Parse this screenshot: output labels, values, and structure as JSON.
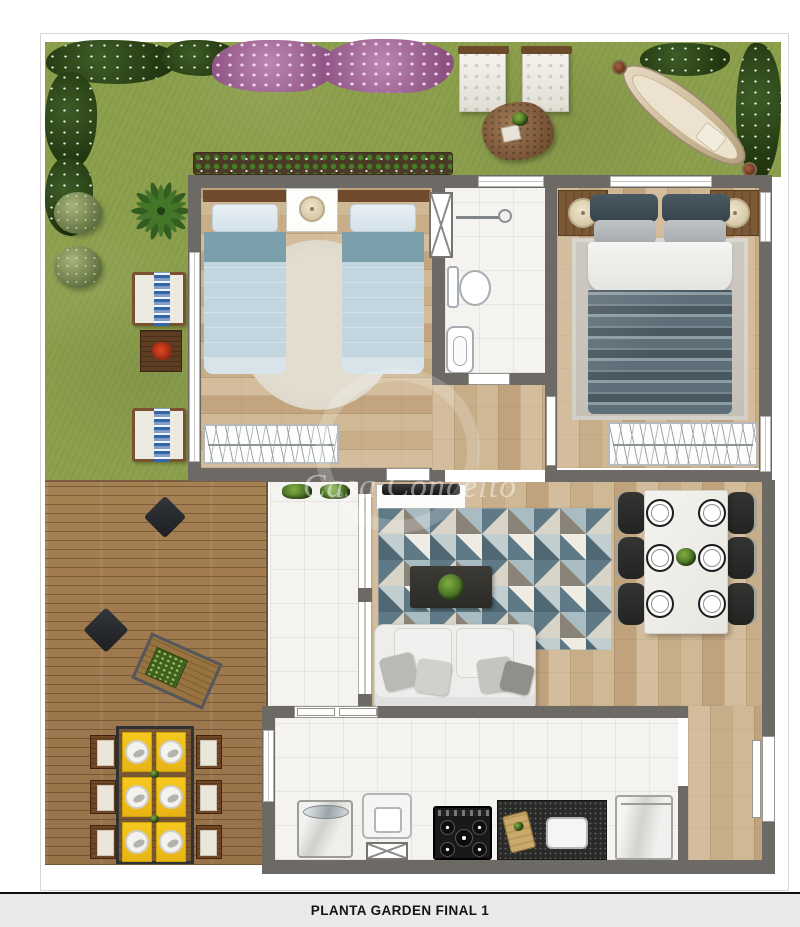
{
  "page": {
    "title": "PLANTA GARDEN FINAL 1",
    "watermark": "Casa Conceito"
  },
  "plan": {
    "type": "residential-floor-plan-top-view",
    "rooms": [
      "garden",
      "wood-deck",
      "patio",
      "twin-bedroom",
      "bathroom",
      "master-bedroom",
      "hall",
      "living-room",
      "dining-room",
      "kitchen",
      "entry"
    ],
    "garden_features": [
      "white-flower-hedge",
      "purple-flower-bed",
      "round-bushes",
      "palm-plant",
      "two-lounge-armchairs",
      "side-table-with-red-flowers",
      "two-white-poufs",
      "rock-planting-mound",
      "hammock",
      "planter-strip"
    ],
    "deck_features": [
      "two-floor-cushions",
      "wood-lounger-with-tray",
      "outdoor-table-for-six",
      "yellow-placemats",
      "six-wood-chairs"
    ],
    "furniture": {
      "twin_bedroom": [
        "twin-bed-left",
        "twin-bed-right",
        "shared-nightstand-with-lamp",
        "round-rug",
        "wardrobe"
      ],
      "bathroom": [
        "shower-with-grab-bar",
        "toilet",
        "sink"
      ],
      "master_bedroom": [
        "double-bed",
        "nightstand-lamp-left",
        "nightstand-lamp-right",
        "area-rug",
        "wardrobe"
      ],
      "living_room": [
        "tv-console",
        "tv",
        "geometric-rug",
        "coffee-table-with-plant",
        "sofa-with-pillows"
      ],
      "dining_room": [
        "white-table-six-settings",
        "six-dark-chairs",
        "plant-centerpiece"
      ],
      "kitchen": [
        "washing-machine",
        "laundry-tub",
        "stove",
        "granite-counter-with-sink",
        "refrigerator"
      ]
    },
    "colors": {
      "grass": "#8da04d",
      "hedge": "#2c4519",
      "flowers": "#b77fac",
      "wall": "#6d6a66",
      "wood_floor": "#cdb694",
      "deck": "#a07b4e",
      "tile": "#f4f3ef",
      "twin_bed": "#c3d6df",
      "twin_accent": "#7ca0ab",
      "master_blanket": "#5d6e78",
      "sofa": "#ececea",
      "placemat": "#f0bf1c",
      "title_bar": "#eaeae9"
    }
  }
}
